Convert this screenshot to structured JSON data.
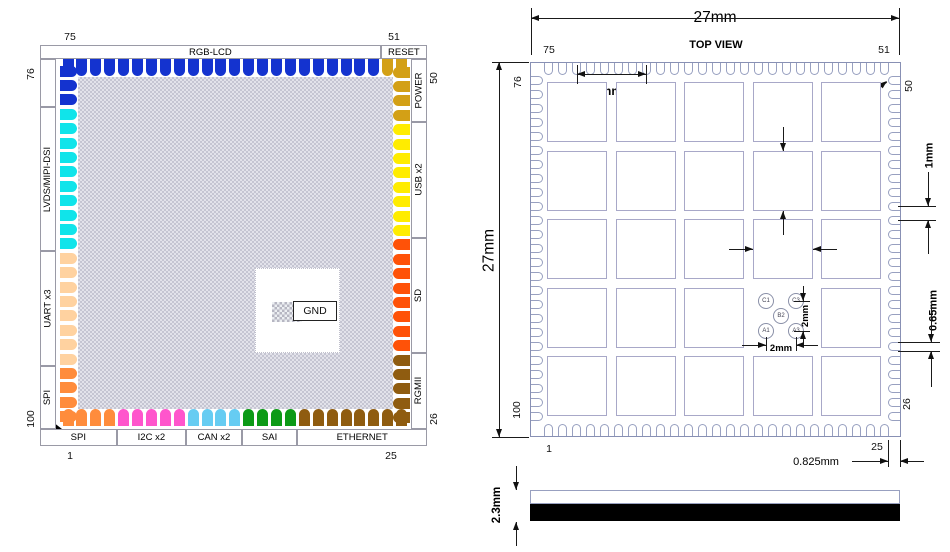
{
  "pinout": {
    "corner_numbers": {
      "top_left": "75",
      "top_right": "51",
      "left_top": "76",
      "left_bottom": "100",
      "right_top": "50",
      "right_bottom": "26",
      "bottom_left": "1",
      "bottom_right": "25"
    },
    "gnd_label": "GND",
    "sides": {
      "top": [
        {
          "label": "RGB-LCD",
          "color": "#1433cf",
          "count": 23
        },
        {
          "label": "RESET",
          "color": "#d3a016",
          "count": 2
        }
      ],
      "right": [
        {
          "label": "POWER",
          "color": "#d3a016",
          "count": 4
        },
        {
          "label": "USB x2",
          "color": "#ffec00",
          "count": 8
        },
        {
          "label": "SD",
          "color": "#ff5208",
          "count": 8
        },
        {
          "label": "RGMII",
          "color": "#8f5c10",
          "count": 5
        }
      ],
      "bottom": [
        {
          "label": "SPI",
          "color": "#ff8c3c",
          "count": 4
        },
        {
          "label": "I2C x2",
          "color": "#ff55cc",
          "count": 5
        },
        {
          "label": "CAN x2",
          "color": "#66ccf2",
          "count": 4
        },
        {
          "label": "SAI",
          "color": "#0c9a16",
          "count": 4
        },
        {
          "label": "ETHERNET",
          "color": "#8f5c10",
          "count": 8
        }
      ],
      "left": [
        {
          "label": "",
          "color": "#1433cf",
          "count": 3
        },
        {
          "label": "LVDS/MIPI-DSI",
          "color": "#10e4ea",
          "count": 10
        },
        {
          "label": "UART x3",
          "color": "#ffd2a0",
          "count": 8
        },
        {
          "label": "SPI",
          "color": "#ff8c3c",
          "count": 4
        }
      ]
    }
  },
  "mech": {
    "title": "TOP VIEW",
    "numbers": {
      "top_left": "75",
      "top_right": "51",
      "left_top": "76",
      "left_bottom": "100",
      "right_top": "50",
      "right_bottom": "26",
      "bottom_left": "1",
      "bottom_right": "25"
    },
    "dims": {
      "overall_width": "27mm",
      "overall_height": "27mm",
      "pad_pitch": "5mm",
      "corner_radius": "R0.325mm",
      "pad_height": "4.3mm",
      "pad_width": "4.3mm",
      "pin_pitch": "1mm",
      "pin_width": "0.65mm",
      "edge_offset": "0.825mm",
      "thickness": "2.3mm",
      "fiducial_dx": "2mm",
      "fiducial_dy": "2mm"
    },
    "fiducials": [
      {
        "label": "C1"
      },
      {
        "label": "C3"
      },
      {
        "label": "B2"
      },
      {
        "label": "A1"
      },
      {
        "label": "A3"
      }
    ]
  }
}
